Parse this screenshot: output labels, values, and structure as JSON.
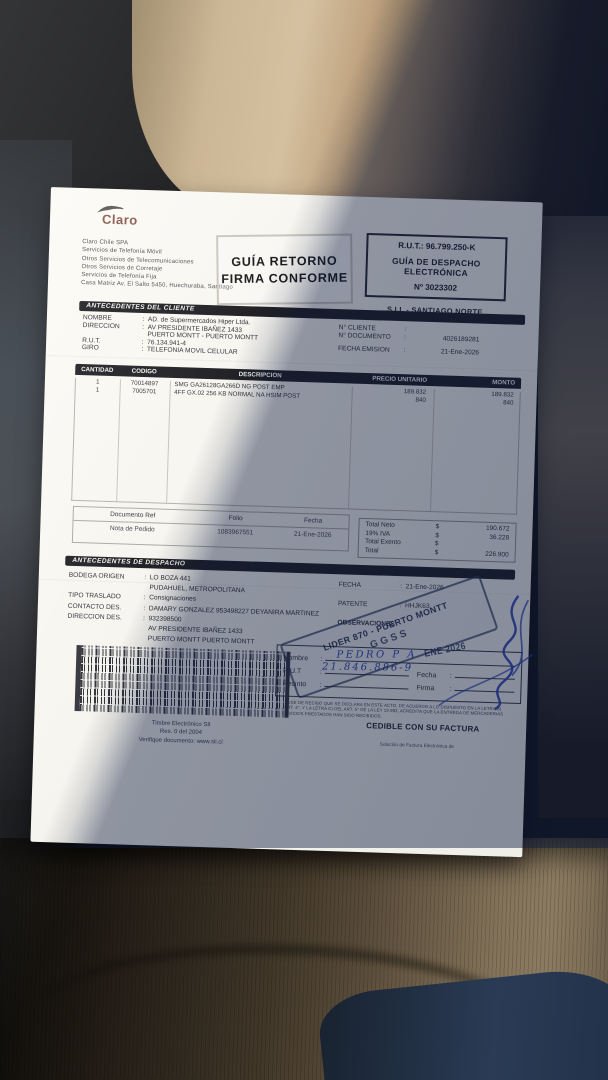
{
  "colors": {
    "paper": "#f6f4ee",
    "shadow_tint": "#0c1a3e",
    "seat_tan": "#c7b08d",
    "seat_brown": "#6f604a",
    "ink_blue": "#2e41b0",
    "stamp_ink": "#28344e",
    "claro_logo": "#8a564c"
  },
  "stamps": {
    "return_line1": "GUÍA RETORNO",
    "return_line2": "FIRMA CONFORME",
    "lider_line1": "LIDER 870 - PUERTO MONTT",
    "lider_line2": "GGSS",
    "date_stamp": "ENE 2026"
  },
  "header": {
    "logo": "Claro",
    "company_lines": [
      "Claro Chile SPA",
      "Servicios de Telefonía Móvil",
      "Otros Servicios de Telecomunicaciones",
      "Otros Servicios de Corretaje",
      "Servicios de Telefonía Fija",
      "Casa Matriz Av. El Salto 5450, Huechuraba, Santiago"
    ],
    "rut_box": {
      "rut": "R.U.T.: 96.799.250-K",
      "doc_type_line1": "GUÍA DE DESPACHO",
      "doc_type_line2": "ELECTRÓNICA",
      "doc_number": "Nº 3023302"
    },
    "sii_office": "S.I.I. - SANTIAGO NORTE"
  },
  "client": {
    "section_title": "ANTECEDENTES DEL CLIENTE",
    "rows": [
      {
        "label": "NOMBRE",
        "value": "AD. de Supermercados Hiper Ltda."
      },
      {
        "label": "DIRECCION",
        "value": "AV PRESIDENTE IBAÑEZ 1433"
      },
      {
        "label": "",
        "value": "PUERTO MONTT -  PUERTO MONTT"
      },
      {
        "label": "R.U.T.",
        "value": "76.134.941-4"
      },
      {
        "label": "GIRO",
        "value": "TELEFONIA MOVIL CELULAR"
      }
    ],
    "doc_rows": [
      {
        "label": "N° CLIENTE",
        "value": ""
      },
      {
        "label": "N° DOCUMENTO",
        "value": "4026189281"
      },
      {
        "label": "FECHA EMISION",
        "value": "21-Ene-2026"
      }
    ]
  },
  "items": {
    "columns": [
      "CANTIDAD",
      "CODIGO",
      "DESCRIPCION",
      "PRECIO UNITARIO",
      "MONTO"
    ],
    "rows": [
      {
        "cantidad": "1",
        "codigo": "70014897",
        "descripcion": "SMG GA26128GA266D NG POST EMP",
        "precio": "189.832",
        "monto": "189.832"
      },
      {
        "cantidad": "1",
        "codigo": "7005701",
        "descripcion": "4FF GX.02 256 KB NORMAL NA HSIM POST",
        "precio": "840",
        "monto": "840"
      }
    ]
  },
  "reference": {
    "columns": [
      "Documento Ref",
      "Folio",
      "Fecha"
    ],
    "row": {
      "doc": "Nota de Pedido",
      "folio": "1083967551",
      "fecha": "21-Ene-2026"
    }
  },
  "totals": {
    "rows": [
      {
        "label": "Total Neto",
        "currency": "$",
        "value": "190.672"
      },
      {
        "label": "19% IVA",
        "currency": "$",
        "value": "36.228"
      },
      {
        "label": "Total Exento",
        "currency": "$",
        "value": ""
      },
      {
        "label": "Total",
        "currency": "$",
        "value": "226.900"
      }
    ]
  },
  "dispatch": {
    "section_title": "ANTECEDENTES DE DESPACHO",
    "rows": [
      {
        "label": "BODEGA ORIGEN",
        "value": "LO BOZA 441"
      },
      {
        "label": "",
        "value": "PUDAHUEL,  METROPOLITANA"
      },
      {
        "label": "TIPO TRASLADO",
        "value": "Consignaciones"
      },
      {
        "label": "CONTACTO DES.",
        "value": "DAMARY GONZALEZ 953498227 DEYANIRA MARTINEZ"
      },
      {
        "label": "DIRECCION DES.",
        "value": "932398500"
      },
      {
        "label": "",
        "value": "AV PRESIDENTE IBAÑEZ 1433"
      },
      {
        "label": "",
        "value": "PUERTO MONTT   PUERTO MONTT"
      }
    ],
    "meta_rows": [
      {
        "label": "FECHA",
        "value": "21-Ene-2026"
      },
      {
        "label": "PATENTE",
        "value": "HHJK63"
      },
      {
        "label": "OBSERVACIONES",
        "value": ""
      }
    ]
  },
  "receipt": {
    "fields": [
      "Nombre",
      "R.U.T",
      "Recinto"
    ],
    "right_fields": [
      "Fecha",
      "Firma"
    ],
    "handwritten_name": "PEDRO P A",
    "handwritten_rut": "21.846.886-9"
  },
  "legal": {
    "fine_print_lines": [
      "EL ACUSE DE RECIBO QUE SE DECLARA EN ESTE ACTO, DE ACUERDO A LO DISPUESTO EN LA LETRA B)",
      "DEL ART. 4°, Y LA LETRA C) DEL ART. 5° DE LA LEY 19.983, ACREDITA QUE LA ENTREGA DE MERCADERIAS",
      "O SERVICIOS PRESTADOS HAN SIDO RECIBIDOS."
    ],
    "cedible": "CEDIBLE CON SU FACTURA",
    "provider_note": "Solución de Factura Electrónica de"
  },
  "timbre": {
    "lines": [
      "Timbre Electrónico SII",
      "Res. 0 del 2004",
      "Verifique documento: www.sii.cl"
    ]
  }
}
